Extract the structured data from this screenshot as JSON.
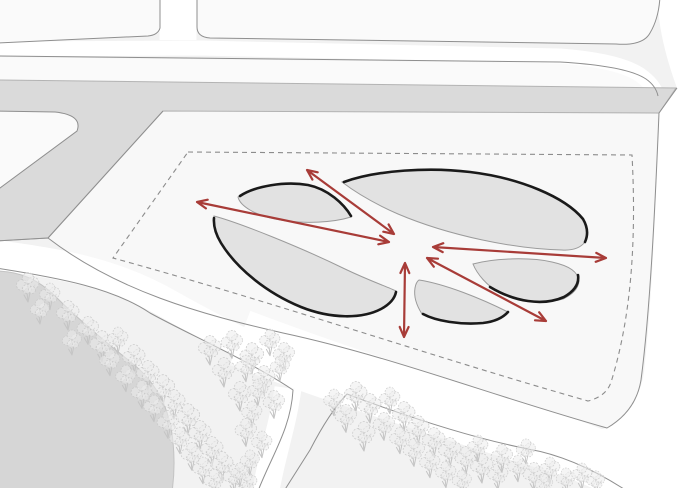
{
  "canvas": {
    "width": 700,
    "height": 488
  },
  "colors": {
    "background": "#f2f2f2",
    "block_fill": "#fafafa",
    "site_fill": "#f8f8f8",
    "road_fill": "#ffffff",
    "line": "#8f8f8f",
    "gray_road": "#dadada",
    "gray_road_edge": "#b3b3b3",
    "water_fill": "#d6d6d6",
    "water_edge": "#c3c3c3",
    "petal_fill": "#e2e2e2",
    "petal_edge_thin": "#9b9b9b",
    "petal_edge_thick": "#1a1a1a",
    "dashed_line": "#8c8c8c",
    "arrow": "#a83c38",
    "tree_stroke": "#c5c5c5",
    "tree_fill": "#ececec"
  },
  "diagram": {
    "arrows": [
      {
        "x1": 197,
        "y1": 202,
        "x2": 389,
        "y2": 242
      },
      {
        "x1": 307,
        "y1": 170,
        "x2": 394,
        "y2": 234
      },
      {
        "x1": 433,
        "y1": 247,
        "x2": 606,
        "y2": 258
      },
      {
        "x1": 427,
        "y1": 258,
        "x2": 546,
        "y2": 321
      },
      {
        "x1": 405,
        "y1": 263,
        "x2": 404,
        "y2": 337
      }
    ],
    "trees": [
      [
        28,
        289,
        1
      ],
      [
        50,
        298,
        0.9
      ],
      [
        40,
        313,
        0.85
      ],
      [
        68,
        317,
        1
      ],
      [
        88,
        332,
        0.95
      ],
      [
        72,
        344,
        0.85
      ],
      [
        102,
        348,
        1.05
      ],
      [
        118,
        342,
        0.9
      ],
      [
        110,
        364,
        0.9
      ],
      [
        134,
        361,
        1
      ],
      [
        126,
        380,
        0.9
      ],
      [
        148,
        377,
        1
      ],
      [
        142,
        396,
        0.95
      ],
      [
        163,
        392,
        1.05
      ],
      [
        154,
        410,
        0.9
      ],
      [
        174,
        406,
        1
      ],
      [
        168,
        426,
        0.95
      ],
      [
        188,
        421,
        1.05
      ],
      [
        180,
        442,
        0.9
      ],
      [
        200,
        437,
        1
      ],
      [
        192,
        458,
        0.95
      ],
      [
        212,
        453,
        1
      ],
      [
        203,
        472,
        0.9
      ],
      [
        222,
        468,
        1
      ],
      [
        214,
        484,
        0.9
      ],
      [
        234,
        480,
        0.95
      ],
      [
        247,
        486,
        0.9
      ],
      [
        210,
        352,
        1
      ],
      [
        232,
        346,
        0.95
      ],
      [
        252,
        360,
        1.05
      ],
      [
        270,
        344,
        0.9
      ],
      [
        284,
        358,
        0.95
      ],
      [
        224,
        374,
        1
      ],
      [
        246,
        370,
        0.9
      ],
      [
        264,
        382,
        1
      ],
      [
        280,
        370,
        0.85
      ],
      [
        240,
        398,
        1
      ],
      [
        258,
        394,
        0.9
      ],
      [
        274,
        406,
        0.95
      ],
      [
        252,
        416,
        0.9
      ],
      [
        246,
        434,
        0.95
      ],
      [
        262,
        446,
        0.9
      ],
      [
        250,
        464,
        0.85
      ],
      [
        240,
        476,
        0.8
      ],
      [
        334,
        404,
        0.9
      ],
      [
        356,
        398,
        1
      ],
      [
        346,
        420,
        0.95
      ],
      [
        370,
        410,
        1
      ],
      [
        390,
        402,
        0.9
      ],
      [
        364,
        438,
        1
      ],
      [
        384,
        428,
        0.95
      ],
      [
        404,
        418,
        1
      ],
      [
        400,
        442,
        0.9
      ],
      [
        418,
        432,
        1
      ],
      [
        414,
        454,
        0.95
      ],
      [
        434,
        444,
        1
      ],
      [
        430,
        466,
        0.9
      ],
      [
        450,
        454,
        1
      ],
      [
        446,
        476,
        0.9
      ],
      [
        466,
        462,
        0.95
      ],
      [
        462,
        484,
        0.85
      ],
      [
        482,
        470,
        1
      ],
      [
        478,
        450,
        0.9
      ],
      [
        498,
        478,
        0.9
      ],
      [
        502,
        460,
        0.95
      ],
      [
        518,
        470,
        0.9
      ],
      [
        534,
        478,
        0.95
      ],
      [
        550,
        472,
        0.9
      ],
      [
        566,
        482,
        0.85
      ],
      [
        582,
        478,
        0.9
      ],
      [
        596,
        484,
        0.8
      ],
      [
        526,
        453,
        0.85
      ],
      [
        544,
        487,
        0.8
      ]
    ]
  }
}
